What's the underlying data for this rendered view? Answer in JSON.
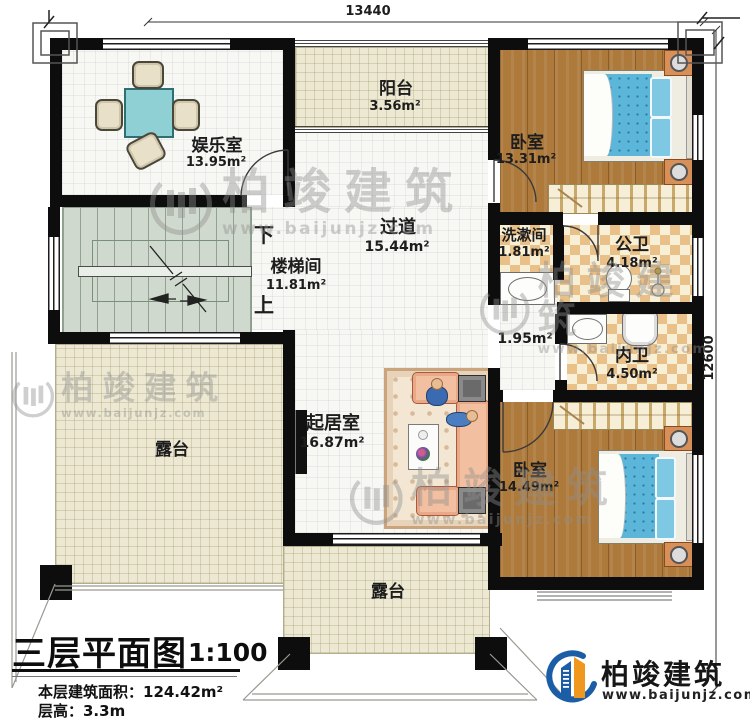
{
  "dimensions": {
    "top": "13440",
    "right": "12600"
  },
  "rooms": {
    "entertainment": {
      "name": "娱乐室",
      "area": "13.95m²"
    },
    "balcony": {
      "name": "阳台",
      "area": "3.56m²"
    },
    "bedroom_top": {
      "name": "卧室",
      "area": "13.31m²"
    },
    "corridor": {
      "name": "过道",
      "area": "15.44m²"
    },
    "stairwell": {
      "name": "楼梯间",
      "area": "11.81m²"
    },
    "washroom": {
      "name": "洗漱间",
      "area": "1.81m²"
    },
    "public_bath": {
      "name": "公卫",
      "area": "4.18m²"
    },
    "hallway": {
      "area": "1.95m²"
    },
    "private_bath": {
      "name": "内卫",
      "area": "4.50m²"
    },
    "living": {
      "name": "起居室",
      "area": "16.87m²"
    },
    "bedroom_bottom": {
      "name": "卧室",
      "area": "14.49m²"
    },
    "terrace_left": {
      "name": "露台"
    },
    "terrace_bottom": {
      "name": "露台"
    }
  },
  "stairs": {
    "down": "下",
    "up": "上"
  },
  "title_block": {
    "title": "三层平面图",
    "scale": "1:100",
    "area_line": "本层建筑面积：124.42m²",
    "height_line": "层高：3.3m"
  },
  "brand": {
    "name": "柏竣建筑",
    "website": "www.baijunjz.com"
  },
  "watermark": {
    "name": "柏竣建筑",
    "website": "www.baijunjz.com"
  },
  "colors": {
    "wall": "#0d0d0d",
    "wood_floor": "#ad7a3c",
    "tile_checker": "#e9c088",
    "terrace": "#ece8d2",
    "stairs": "#cfd9cd",
    "bed": "#5cb6da",
    "table": "#8ed0d4",
    "sofa": "#f2bfa0",
    "brand_blue": "#1b5ea6",
    "brand_orange": "#f0981d"
  }
}
